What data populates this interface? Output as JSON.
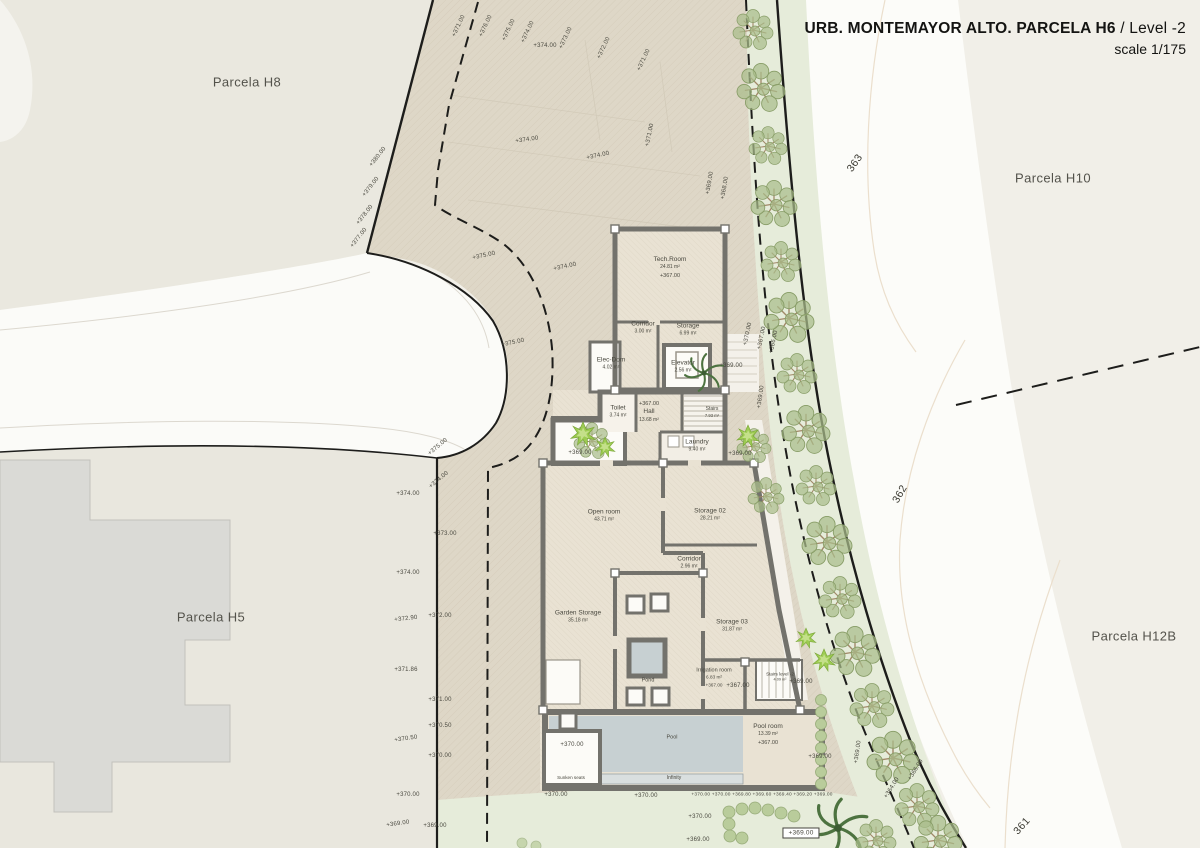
{
  "title": {
    "project": "URB. MONTEMAYOR ALTO. PARCELA H6",
    "separator": " / ",
    "level": "Level -2",
    "scale": "scale 1/175"
  },
  "parcels": [
    {
      "id": "h8",
      "label": "Parcela H8",
      "x": 247,
      "y": 82
    },
    {
      "id": "h5",
      "label": "Parcela H5",
      "x": 211,
      "y": 617
    },
    {
      "id": "h10",
      "label": "Parcela H10",
      "x": 1053,
      "y": 178
    },
    {
      "id": "h12b",
      "label": "Parcela H12B",
      "x": 1134,
      "y": 636
    }
  ],
  "contour_labels": [
    {
      "t": "363",
      "x": 855,
      "y": 163,
      "r": -55
    },
    {
      "t": "362",
      "x": 900,
      "y": 494,
      "r": -60
    },
    {
      "t": "361",
      "x": 1022,
      "y": 826,
      "r": -48
    }
  ],
  "rooms": [
    {
      "id": "tech-room",
      "name": "Tech.Room",
      "area": "24.81 m²",
      "elev": "+367.00",
      "x": 670,
      "y": 268
    },
    {
      "id": "corridor-1",
      "name": "Corridor",
      "area": "3.00 m²",
      "x": 643,
      "y": 328
    },
    {
      "id": "storage-1",
      "name": "Storage",
      "area": "6.99 m²",
      "x": 688,
      "y": 330
    },
    {
      "id": "elec-dom",
      "name": "Elec-Dom",
      "area": "4.02 m²",
      "x": 611,
      "y": 364
    },
    {
      "id": "elevator",
      "name": "Elevator",
      "area": "2.56 m²",
      "x": 683,
      "y": 367
    },
    {
      "id": "toilet",
      "name": "Toilet",
      "area": "3.74 m²",
      "x": 618,
      "y": 412
    },
    {
      "id": "hall",
      "name": "Hall",
      "area": "13.68 m²",
      "elev": "+367.00",
      "elevFirst": true,
      "x": 649,
      "y": 411
    },
    {
      "id": "stairs",
      "name": "Stairs",
      "area": "7.93 m²",
      "x": 712,
      "y": 412,
      "s": 5
    },
    {
      "id": "laundry",
      "name": "Laundry",
      "area": "9.40 m²",
      "x": 697,
      "y": 446
    },
    {
      "id": "open-room",
      "name": "Open room",
      "area": "43.71 m²",
      "x": 604,
      "y": 516
    },
    {
      "id": "storage-02",
      "name": "Storage 02",
      "area": "28.21 m²",
      "x": 710,
      "y": 515
    },
    {
      "id": "corridor-2",
      "name": "Corridor",
      "area": "2.96 m²",
      "x": 689,
      "y": 563
    },
    {
      "id": "garden-storage",
      "name": "Garden Storage",
      "area": "35.18 m²",
      "x": 578,
      "y": 617
    },
    {
      "id": "storage-03",
      "name": "Storage 03",
      "area": "31.87 m²",
      "x": 732,
      "y": 626
    },
    {
      "id": "pond",
      "name": "Pond",
      "x": 648,
      "y": 681,
      "s": 5.5
    },
    {
      "id": "irrigation-room",
      "name": "Irrigation room",
      "area": "6.83 m²",
      "elev": "+367.00",
      "x": 714,
      "y": 678,
      "s": 5.5
    },
    {
      "id": "stairs-level-2",
      "name": "Stairs level -2",
      "area": "4.09 m²",
      "x": 780,
      "y": 677,
      "s": 4.6
    },
    {
      "id": "pool",
      "name": "Pool",
      "x": 672,
      "y": 738,
      "s": 5.5
    },
    {
      "id": "pool-room",
      "name": "Pool room",
      "area": "13.39 m²",
      "elev": "+367.00",
      "x": 768,
      "y": 735
    },
    {
      "id": "sunken-seats",
      "name": "Sunken seats",
      "x": 571,
      "y": 778,
      "s": 4.6
    },
    {
      "id": "infinity",
      "name": "Infinity",
      "x": 674,
      "y": 778,
      "s": 5
    }
  ],
  "spot_elevations": [
    {
      "t": "+371.00",
      "x": 459,
      "y": 26,
      "r": -65
    },
    {
      "t": "+376.00",
      "x": 486,
      "y": 26,
      "r": -65
    },
    {
      "t": "+375.00",
      "x": 509,
      "y": 30,
      "r": -65
    },
    {
      "t": "+374.00",
      "x": 528,
      "y": 32,
      "r": -65
    },
    {
      "t": "+374.00",
      "x": 545,
      "y": 46,
      "r": 0
    },
    {
      "t": "+373.00",
      "x": 566,
      "y": 38,
      "r": -65
    },
    {
      "t": "+372.00",
      "x": 604,
      "y": 48,
      "r": -65
    },
    {
      "t": "+371.00",
      "x": 644,
      "y": 60,
      "r": -65
    },
    {
      "t": "+371.00",
      "x": 650,
      "y": 135,
      "r": -78
    },
    {
      "t": "+374.00",
      "x": 527,
      "y": 140,
      "r": -8
    },
    {
      "t": "+374.00",
      "x": 598,
      "y": 156,
      "r": -12
    },
    {
      "t": "+380.00",
      "x": 378,
      "y": 157,
      "r": -52
    },
    {
      "t": "+379.00",
      "x": 371,
      "y": 187,
      "r": -52
    },
    {
      "t": "+378.00",
      "x": 365,
      "y": 215,
      "r": -52
    },
    {
      "t": "+377.00",
      "x": 359,
      "y": 238,
      "r": -52
    },
    {
      "t": "+375.00",
      "x": 484,
      "y": 256,
      "r": -12
    },
    {
      "t": "+374.00",
      "x": 565,
      "y": 267,
      "r": -12
    },
    {
      "t": "+375.00",
      "x": 513,
      "y": 343,
      "r": -12
    },
    {
      "t": "+369.00",
      "x": 710,
      "y": 183,
      "r": -80
    },
    {
      "t": "+368.00",
      "x": 725,
      "y": 188,
      "r": -80
    },
    {
      "t": "+370.00",
      "x": 748,
      "y": 334,
      "r": -78
    },
    {
      "t": "+367.00",
      "x": 762,
      "y": 338,
      "r": -78
    },
    {
      "t": "+366.00",
      "x": 774,
      "y": 342,
      "r": -78
    },
    {
      "t": "+369.00",
      "x": 731,
      "y": 366,
      "r": 0
    },
    {
      "t": "+369.00",
      "x": 761,
      "y": 397,
      "r": -82
    },
    {
      "t": "+369.00",
      "x": 740,
      "y": 454,
      "r": 0
    },
    {
      "t": "+369.00",
      "x": 580,
      "y": 453,
      "r": 0
    },
    {
      "t": "+375.00",
      "x": 438,
      "y": 447,
      "r": -40
    },
    {
      "t": "+374.00",
      "x": 439,
      "y": 480,
      "r": -40
    },
    {
      "t": "+374.00",
      "x": 408,
      "y": 494,
      "r": 0
    },
    {
      "t": "+373.00",
      "x": 445,
      "y": 534,
      "r": 0
    },
    {
      "t": "+374.00",
      "x": 408,
      "y": 573,
      "r": 0
    },
    {
      "t": "+372.00",
      "x": 440,
      "y": 616,
      "r": 0
    },
    {
      "t": "+372.90",
      "x": 406,
      "y": 619,
      "r": -6
    },
    {
      "t": "+371.86",
      "x": 406,
      "y": 670,
      "r": 0
    },
    {
      "t": "+371.00",
      "x": 440,
      "y": 700,
      "r": 0
    },
    {
      "t": "+370.50",
      "x": 440,
      "y": 726,
      "r": 0
    },
    {
      "t": "+370.50",
      "x": 406,
      "y": 739,
      "r": -8
    },
    {
      "t": "+370.00",
      "x": 440,
      "y": 756,
      "r": 0
    },
    {
      "t": "+370.00",
      "x": 408,
      "y": 795,
      "r": 0
    },
    {
      "t": "+369.00",
      "x": 398,
      "y": 824,
      "r": -8
    },
    {
      "t": "+369.00",
      "x": 435,
      "y": 826,
      "r": 0
    },
    {
      "t": "+367.00",
      "x": 738,
      "y": 686,
      "r": 0
    },
    {
      "t": "+369.00",
      "x": 801,
      "y": 682,
      "r": 0
    },
    {
      "t": "+369.00",
      "x": 820,
      "y": 757,
      "r": 0
    },
    {
      "t": "+369.00",
      "x": 858,
      "y": 752,
      "r": -82
    },
    {
      "t": "+366.00",
      "x": 916,
      "y": 770,
      "r": -58
    },
    {
      "t": "+364.00",
      "x": 892,
      "y": 788,
      "r": -58
    },
    {
      "t": "+370.00",
      "x": 572,
      "y": 745,
      "r": 0
    },
    {
      "t": "+370.00",
      "x": 556,
      "y": 795,
      "r": 0
    },
    {
      "t": "+370.00",
      "x": 646,
      "y": 796,
      "r": 0
    },
    {
      "t": "+370.00 +370.00 +369.80 +369.60 +369.40 +369.20 +369.00",
      "x": 762,
      "y": 795,
      "r": 0,
      "s": 4.8
    },
    {
      "t": "+370.00",
      "x": 700,
      "y": 817,
      "r": 0
    },
    {
      "t": "+369.00",
      "x": 698,
      "y": 840,
      "r": 0
    },
    {
      "t": "+369.00",
      "x": 801,
      "y": 833,
      "r": 0,
      "box": true
    }
  ],
  "colors": {
    "terrain": "#ded7c7",
    "floor": "#e9e2d3",
    "wall": "#73726c",
    "water": "#c7d0d2",
    "green_band": "#e6ecda",
    "tree": "#a9bc8b",
    "road": "#fbfbf8",
    "boundary": "#1d1d1b"
  }
}
